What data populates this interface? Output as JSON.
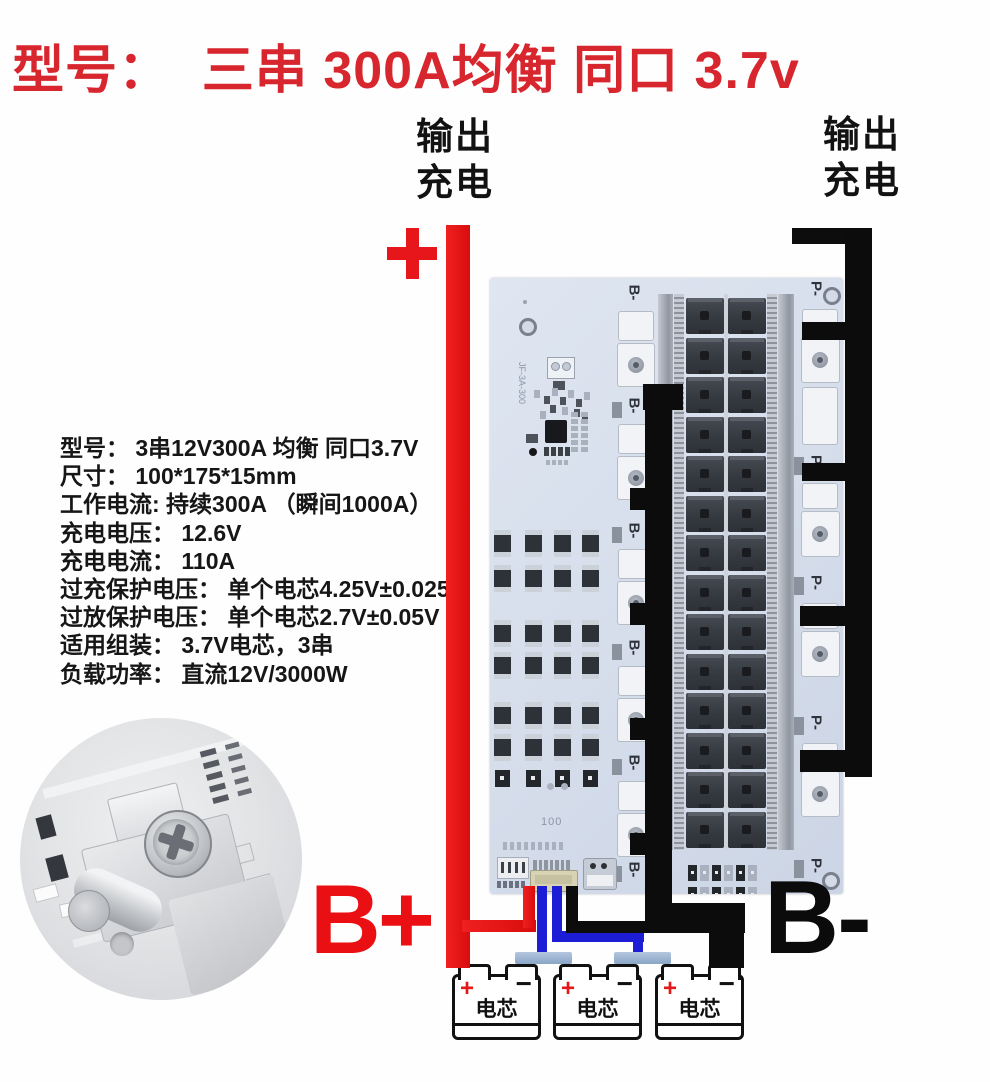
{
  "title": "型号：  三串 300A均衡 同口 3.7v",
  "output_labels": {
    "left": [
      "输出",
      "充电"
    ],
    "right": [
      "输出",
      "充电"
    ]
  },
  "terminals": {
    "b_plus": "B+",
    "b_minus": "B-"
  },
  "specs": [
    "型号： 3串12V300A 均衡 同口3.7V",
    "尺寸： 100*175*15mm",
    "工作电流: 持续300A （瞬间1000A）",
    "充电电压： 12.6V",
    "充电电流： 110A",
    "过充保护电压： 单个电芯4.25V±0.025V",
    "过放保护电压： 单个电芯2.7V±0.05V",
    "适用组装： 3.7V电芯，3串",
    "负载功率： 直流12V/3000W"
  ],
  "board": {
    "silkscreen_model": "JF-3A-300",
    "silkscreen_number": "100",
    "left_terminal_label": "B-",
    "right_terminal_label": "P-",
    "left_terminal_count": 6,
    "right_terminal_count": 5,
    "mosfet_rows": 14,
    "mosfet_cols": 2
  },
  "batteries": {
    "count": 3,
    "label": "电芯",
    "plus": "+",
    "minus": "−"
  },
  "colors": {
    "title_red": "#d8262e",
    "wire_red": "#ec1212",
    "wire_blue": "#1d1dd6",
    "wire_black": "#0c0c0c",
    "board_blue": "#d7dfee",
    "busbar_blue": "#8aa5c6",
    "b_plus_red": "#ea0f13"
  }
}
